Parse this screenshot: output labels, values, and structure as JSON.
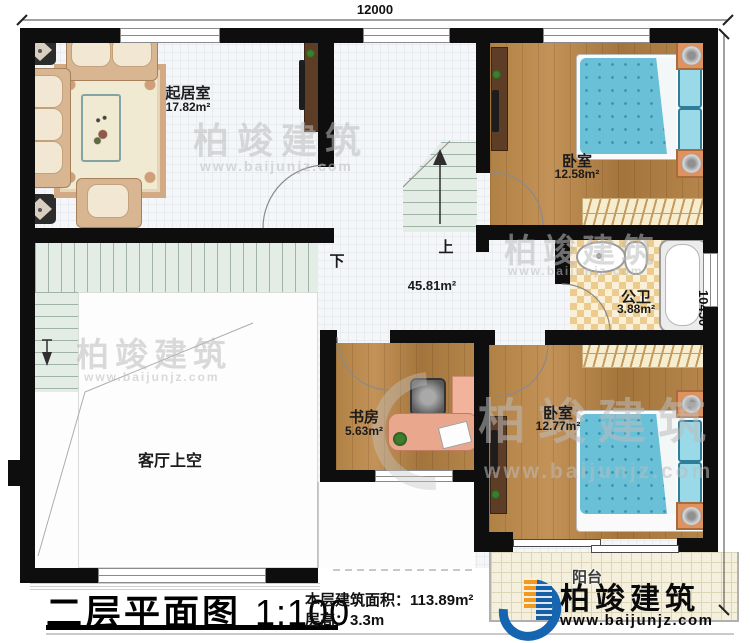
{
  "dimensions": {
    "top": "12000",
    "right": "10450"
  },
  "rooms": {
    "living": {
      "label": "起居室",
      "area": "17.82m²"
    },
    "bedroom1": {
      "label": "卧室",
      "area": "12.58m²"
    },
    "bath": {
      "label": "公卫",
      "area": "3.88m²"
    },
    "study": {
      "label": "书房",
      "area": "5.63m²"
    },
    "bedroom2": {
      "label": "卧室",
      "area": "12.77m²"
    },
    "void": {
      "label": "客厅上空"
    },
    "balcony": {
      "label": "阳台"
    },
    "hall": {
      "area": "45.81m²"
    }
  },
  "stairs": {
    "up": "上",
    "down": "下"
  },
  "title": {
    "name": "二层平面图",
    "scale": "1:100"
  },
  "info": {
    "area_label": "本层建筑面积：",
    "area_value": "113.89m²",
    "height_label": "层高：",
    "height_value": "3.3m"
  },
  "brand": {
    "name": "柏竣建筑",
    "url": "www.baijunjz.com"
  },
  "watermark": {
    "name": "柏竣建筑",
    "url": "www.baijunjz.com"
  },
  "colors": {
    "wall": "#0e0e0e",
    "wood": "#b08144",
    "bed": "#6ac0d6",
    "tile": "#eccb8e",
    "stair": "#e4ede5",
    "brand_blue": "#1565b0",
    "brand_orange": "#f29a1f"
  }
}
